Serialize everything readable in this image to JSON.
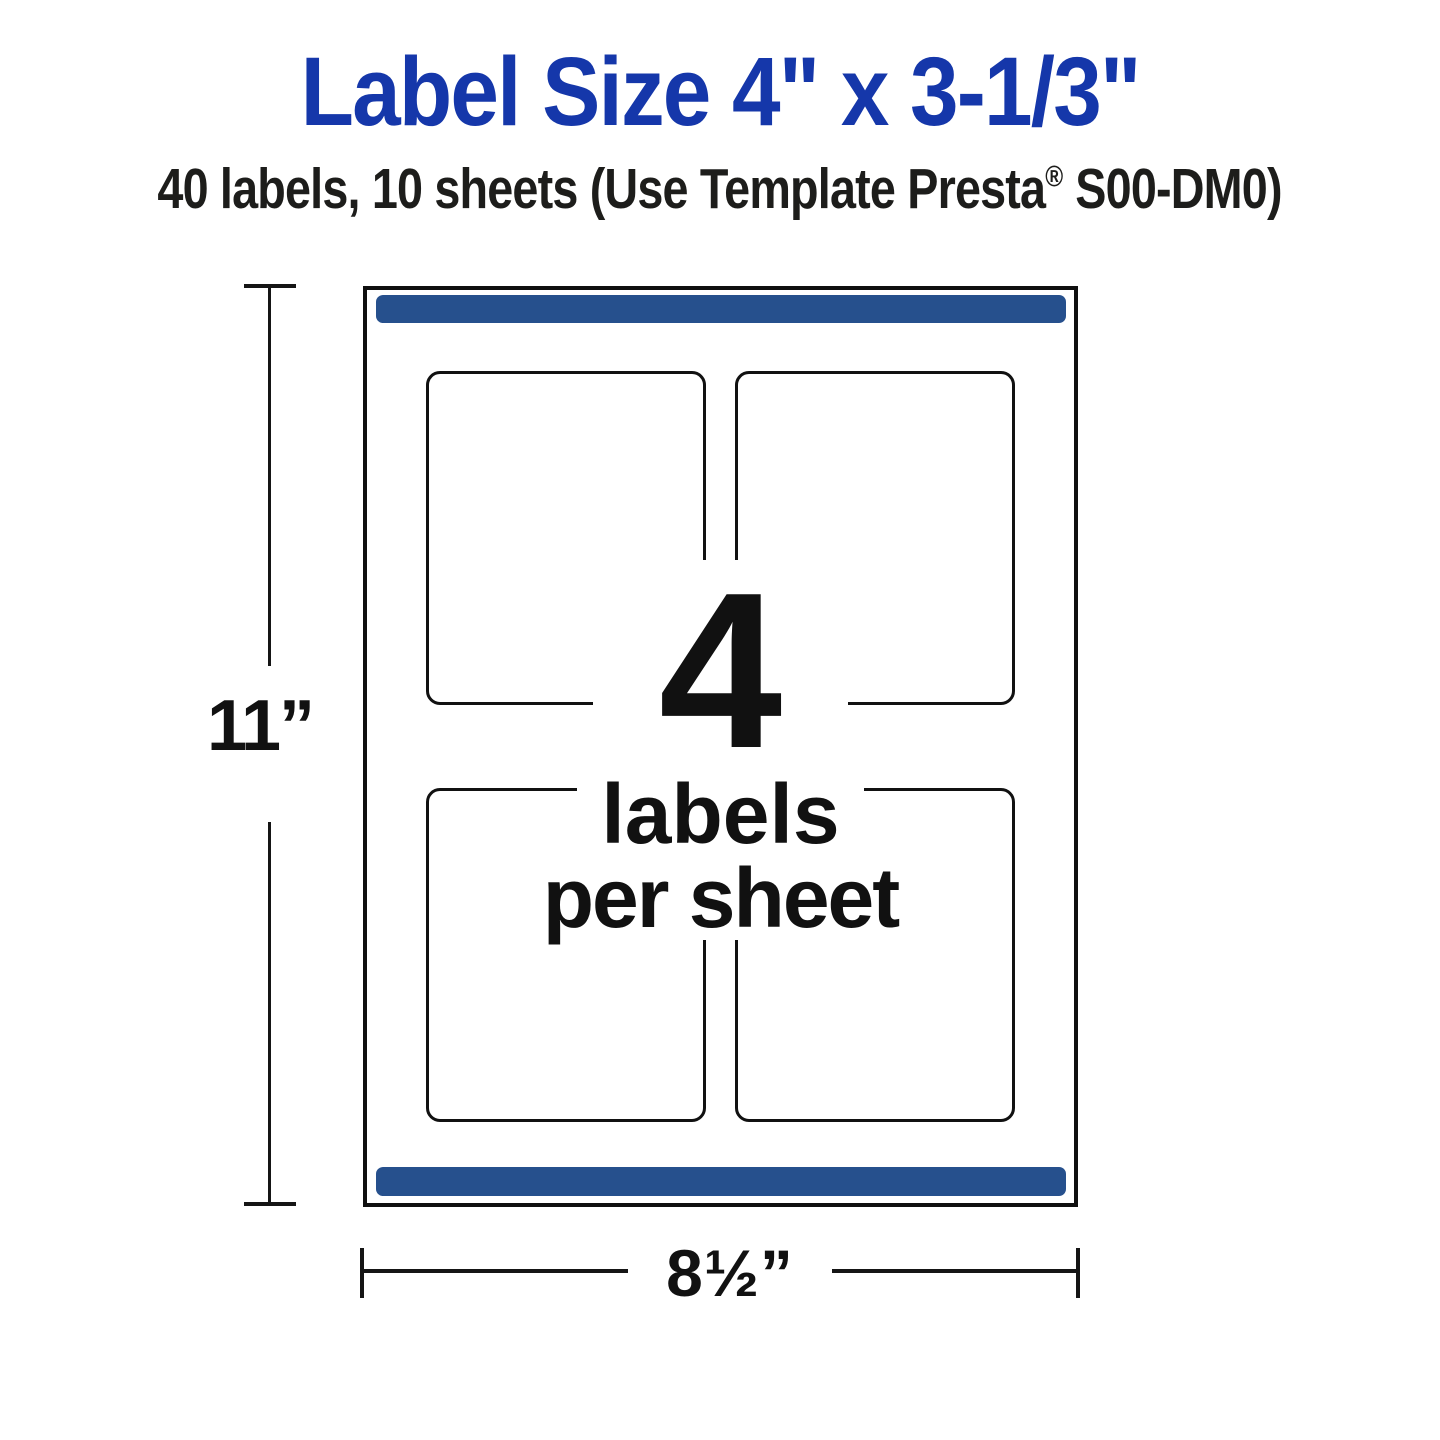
{
  "header": {
    "title": "Label Size 4\" x 3-1/3\"",
    "subtitle_pre": "40 labels, 10 sheets (Use Template Presta",
    "registered_mark": "®",
    "subtitle_post": " S00-DM0)"
  },
  "sheet_callout": {
    "big_count": "4",
    "line1": "labels",
    "line2": "per sheet"
  },
  "dimensions": {
    "height_label": "11”",
    "width_label": "8½”"
  },
  "colors": {
    "title_blue": "#1537aa",
    "margin_bar_blue": "#26508d",
    "ink_black": "#111111",
    "sheet_background": "#ffffff"
  }
}
